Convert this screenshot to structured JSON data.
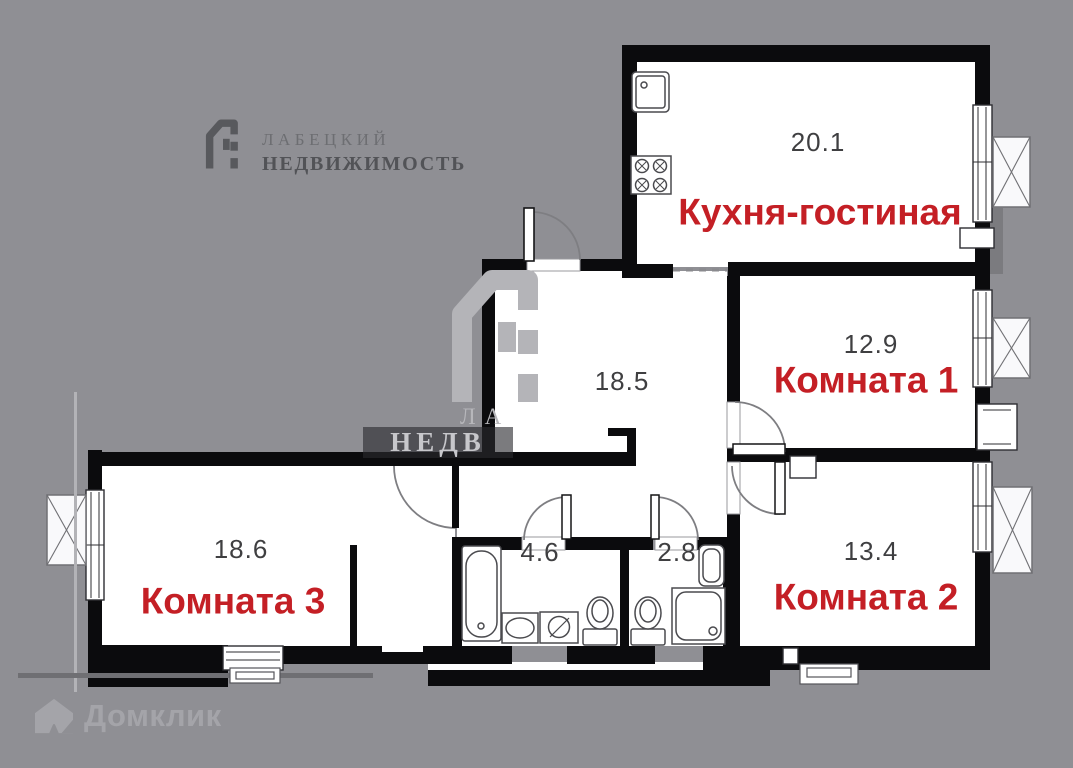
{
  "branding": {
    "agency_name_line1": "ЛАБЕЦКИЙ",
    "agency_name_line2": "НЕДВИЖИМОСТЬ"
  },
  "center_watermark": {
    "line1": "ЛА",
    "line2": "НЕДВ"
  },
  "footer_watermark": {
    "portal_name": "Домклик"
  },
  "rooms": {
    "kitchen": {
      "name": "Кухня-гостиная",
      "area": "20.1"
    },
    "room1": {
      "name": "Комната 1",
      "area": "12.9"
    },
    "room2": {
      "name": "Комната 2",
      "area": "13.4"
    },
    "room3": {
      "name": "Комната 3",
      "area": "18.6"
    },
    "hall": {
      "area": "18.5"
    },
    "bathroom": {
      "area": "4.6"
    },
    "wc": {
      "area": "2.8"
    }
  },
  "colors": {
    "background": "#8f8f94",
    "wall": "#0b0b0d",
    "room_label": "#c41f25",
    "area_value": "#3f3f41"
  }
}
